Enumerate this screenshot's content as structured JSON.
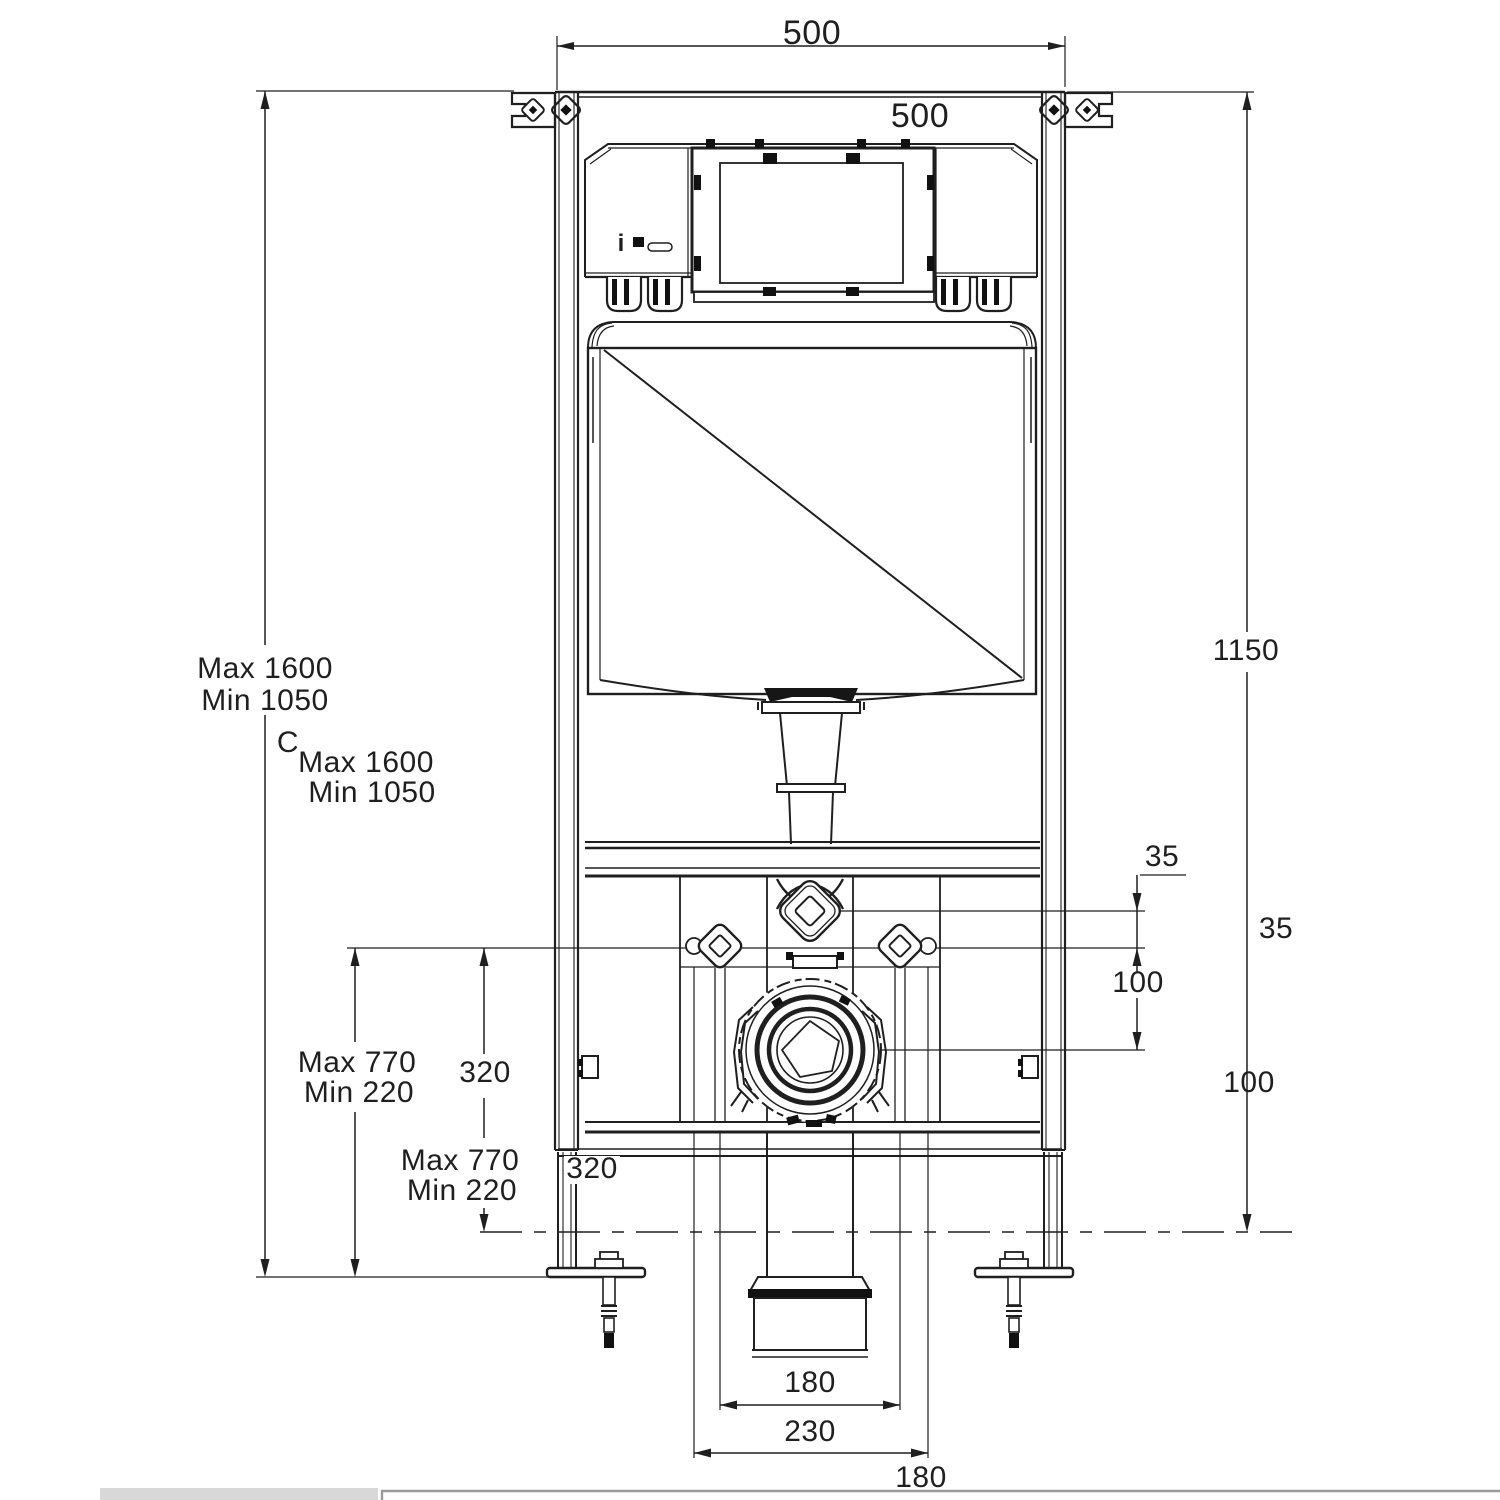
{
  "drawing": {
    "type": "technical-installation-drawing",
    "subject": "Wall-hung WC concealed cistern mounting frame - front elevation",
    "units": "mm",
    "colors": {
      "line": "#1f1f1f",
      "footer_bar": "#d8d8d8",
      "panel_border": "#9a9a9a"
    },
    "labels": {
      "top_width": "500",
      "top_width_dup": "500",
      "frame_height_max": "Max 1600",
      "frame_height_min": "Min 1050",
      "frame_height_max_dup": "Max 1600",
      "frame_height_min_dup": "Min 1050",
      "section_mark": "C",
      "right_height": "1150",
      "inlet_offset": "35",
      "inlet_offset_dup": "35",
      "drain_offset": "100",
      "drain_offset_dup": "100",
      "pan_height_max": "Max 770",
      "pan_height_min": "Min 220",
      "pan_height_max_dup": "Max 770",
      "pan_height_min_dup": "Min 220",
      "drain_height": "320",
      "drain_height_dup": "320",
      "outlet_width": "180",
      "outlet_width_dup": "180",
      "fixing_spacing": "230",
      "info_mark": "i"
    }
  }
}
